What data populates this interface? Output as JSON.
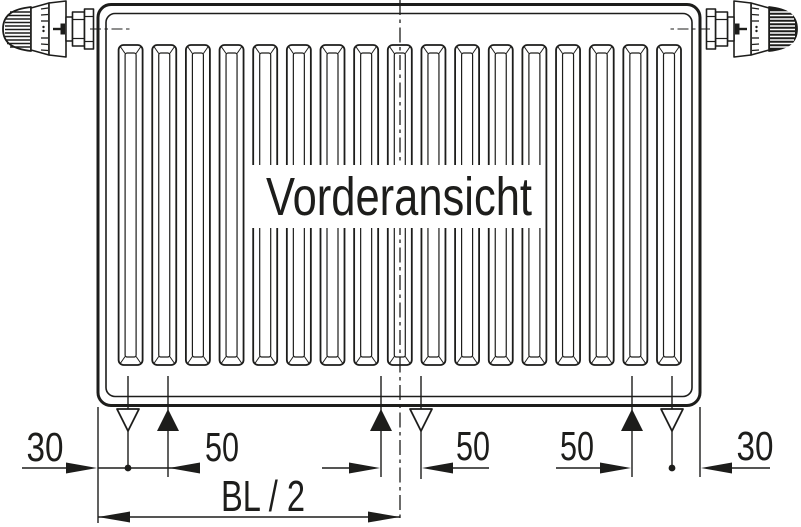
{
  "diagram": {
    "title": "Vorderansicht",
    "dim_bottom": {
      "left_offset": "30",
      "left_spacing": "50",
      "center_spacing": "50",
      "right_spacing": "50",
      "right_offset": "30",
      "half_length": "BL / 2"
    },
    "colors": {
      "ink": "#1d1d1b",
      "paper": "#ffffff"
    },
    "icons": {
      "left_valve": "thermostat-valve-icon",
      "right_valve": "thermostat-valve-dark-icon",
      "marker_up": "filled-triangle-marker",
      "marker_down": "open-triangle-marker",
      "center_axis": "dash-dot-centerline"
    }
  }
}
